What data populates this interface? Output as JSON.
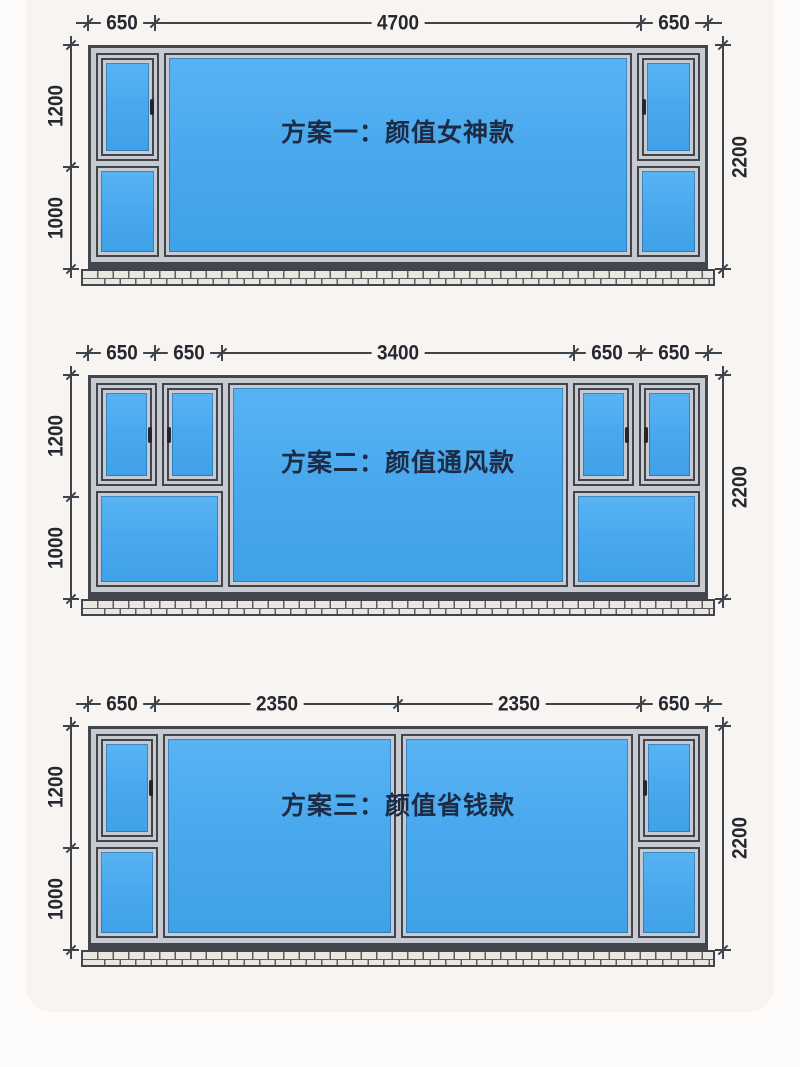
{
  "plans": [
    {
      "title": "方案一：颜值女神款",
      "top_dims": [
        "650",
        "4700",
        "650"
      ],
      "left_dims": [
        "1200",
        "1000"
      ],
      "right_dim": "2200"
    },
    {
      "title": "方案二：颜值通风款",
      "top_dims": [
        "650",
        "650",
        "3400",
        "650",
        "650"
      ],
      "left_dims": [
        "1200",
        "1000"
      ],
      "right_dim": "2200"
    },
    {
      "title": "方案三：颜值省钱款",
      "top_dims": [
        "650",
        "2350",
        "2350",
        "650"
      ],
      "left_dims": [
        "1200",
        "1000"
      ],
      "right_dim": "2200"
    }
  ],
  "colors": {
    "glass_blue": "#4aa9ee",
    "frame_gray": "#c7cbd1",
    "frame_outline": "#41454c",
    "dimension_text": "#25282e",
    "title_text": "#1d2b45",
    "background": "#f7f4f1"
  }
}
